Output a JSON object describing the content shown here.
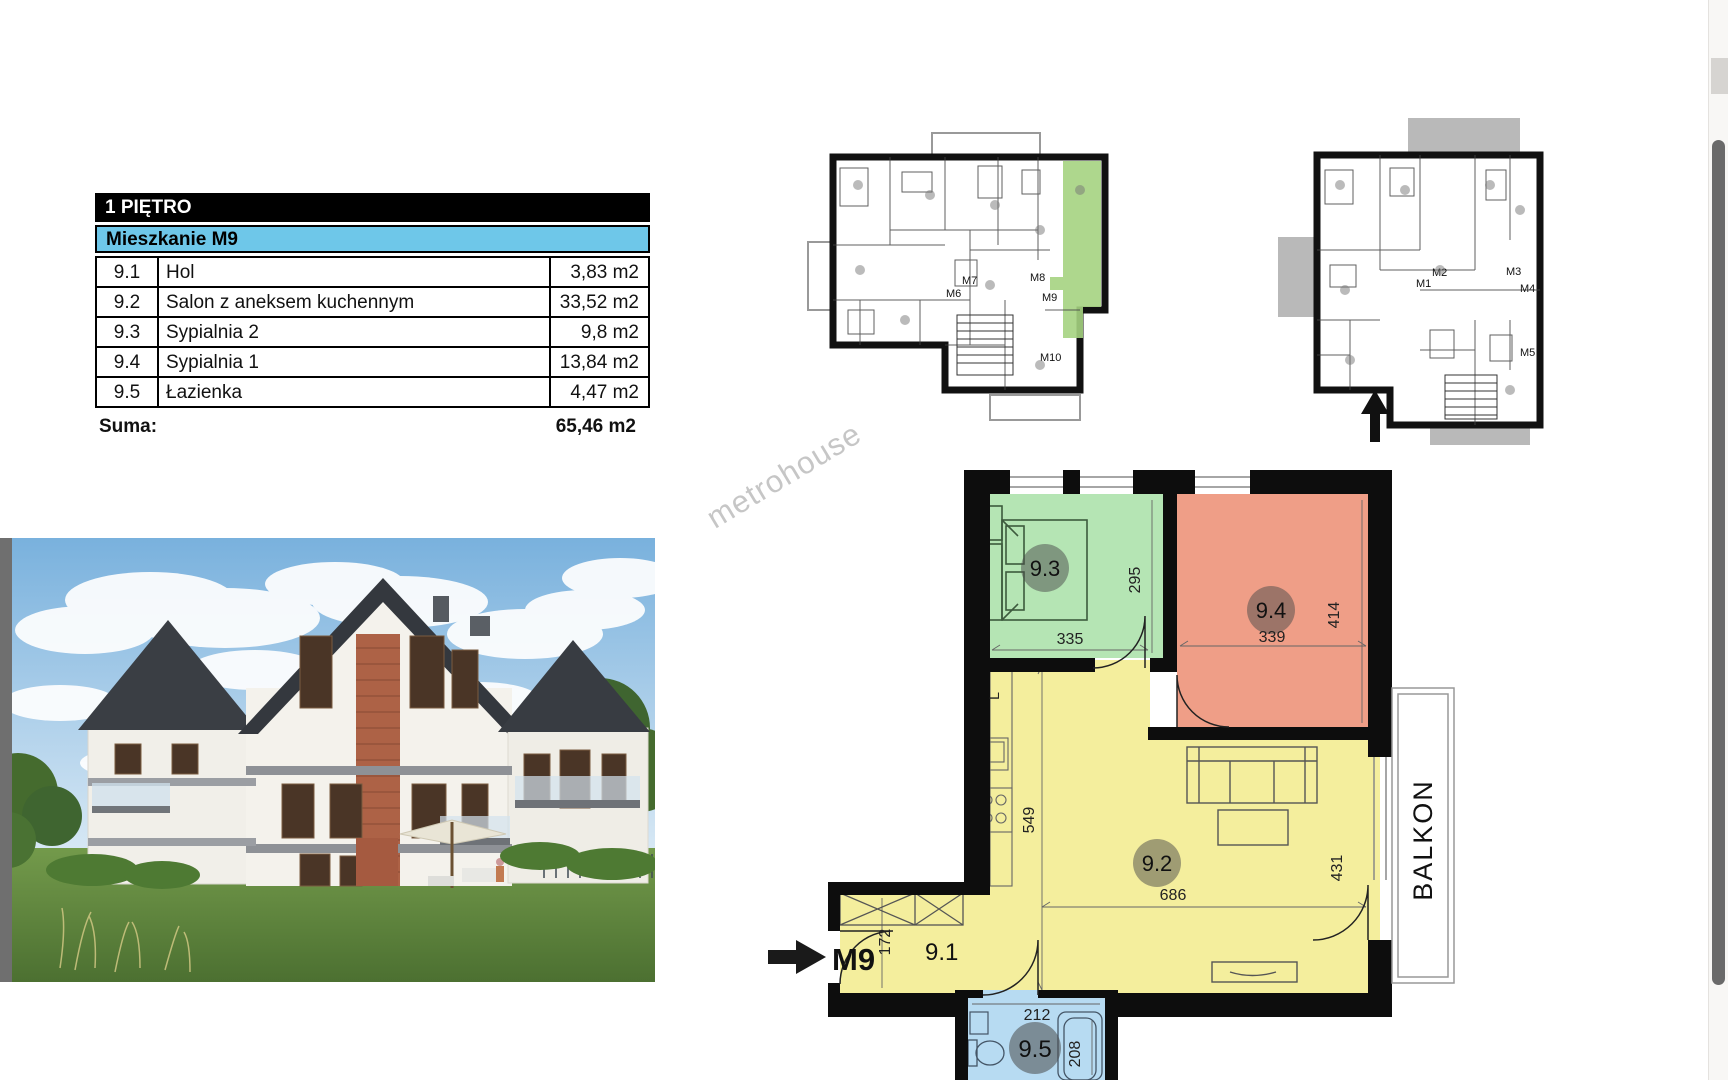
{
  "watermark": {
    "text": "metrohouse",
    "color": "#c6c6c6"
  },
  "area_table": {
    "floor_header": "1 PIĘTRO",
    "apartment_header": "Mieszkanie M9",
    "header_bg": "#000000",
    "apartment_bg": "#6ec7e9",
    "rows": [
      {
        "no": "9.1",
        "name": "Hol",
        "area": "3,83 m2"
      },
      {
        "no": "9.2",
        "name": "Salon z aneksem kuchennym",
        "area": "33,52 m2"
      },
      {
        "no": "9.3",
        "name": "Sypialnia 2",
        "area": "9,8 m2"
      },
      {
        "no": "9.4",
        "name": "Sypialnia 1",
        "area": "13,84 m2"
      },
      {
        "no": "9.5",
        "name": "Łazienka",
        "area": "4,47 m2"
      }
    ],
    "sum_label": "Suma:",
    "sum_value": "65,46 m2"
  },
  "overview_plans": {
    "first_floor": {
      "apartment_labels": [
        "M6",
        "M7",
        "M8",
        "M9",
        "M10"
      ],
      "highlight_color": "#a5d381"
    },
    "ground_floor": {
      "apartment_labels": [
        "M1",
        "M2",
        "M3",
        "M4",
        "M5"
      ],
      "terrace_color": "#b9b9b9"
    }
  },
  "main_plan": {
    "entrance_label": "M9",
    "balcony_label": "BALKON",
    "kitchen_unit_label": "L",
    "rooms": {
      "hall": {
        "id": "9.1",
        "color": "#f4ee9d"
      },
      "living": {
        "id": "9.2",
        "color": "#f4ee9d"
      },
      "bedroom2": {
        "id": "9.3",
        "color": "#b5e5b4"
      },
      "bedroom1": {
        "id": "9.4",
        "color": "#ef9e87"
      },
      "bathroom": {
        "id": "9.5",
        "color": "#b7dbf2"
      }
    },
    "dimensions": {
      "bedroom2_width": "335",
      "bedroom2_height": "295",
      "bedroom1_width": "339",
      "bedroom1_height": "414",
      "kitchen_height": "549",
      "living_width": "686",
      "living_height": "431",
      "hall_width": "172",
      "bathroom_width": "212",
      "bathroom_height": "208"
    }
  }
}
